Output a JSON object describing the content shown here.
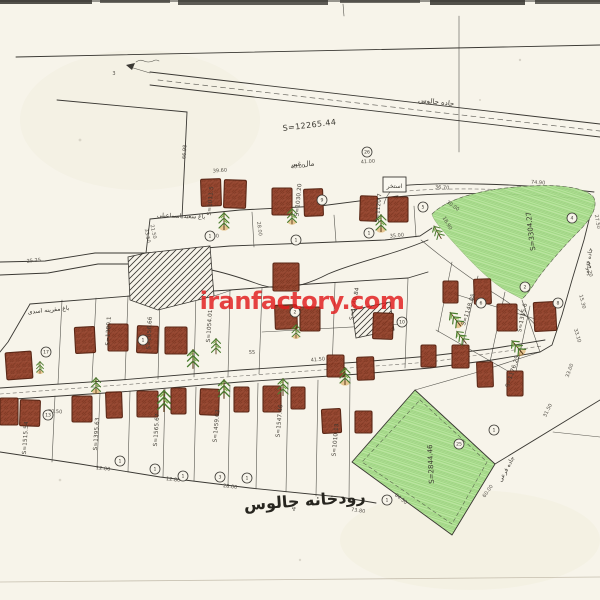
{
  "watermark": {
    "text": "iranfactory.com",
    "color": "#e21b1b"
  },
  "labels": {
    "river": "رودخانه چالوس",
    "road_top": "جاده چالوس",
    "pool": "استخر",
    "side_road_1": "جاده فرعی",
    "side_road_2": "جاده فرعی",
    "others_property": "مال غیر",
    "orchard_note_1": "باغ سعید اسماعیلی",
    "orchard_note_2": "باغ مقرینه اسدی",
    "total_area": "S=12265.44",
    "green_area_top": "S=3304.27",
    "green_area_bottom": "S=2844.46"
  },
  "plot_area_labels": [
    {
      "t": "S=1011.5",
      "x": 212,
      "y": 201,
      "r": -85
    },
    {
      "t": "S=1030.20",
      "x": 300,
      "y": 200,
      "r": -85
    },
    {
      "t": "S=1120.7",
      "x": 380,
      "y": 208,
      "r": -85
    },
    {
      "t": "S=1380.1",
      "x": 110,
      "y": 331,
      "r": -87
    },
    {
      "t": "S=1056.66",
      "x": 151,
      "y": 333,
      "r": -87
    },
    {
      "t": "S=1054.01",
      "x": 211,
      "y": 326,
      "r": -86
    },
    {
      "t": "S=1249.84",
      "x": 356,
      "y": 304,
      "r": -80
    },
    {
      "t": "S=1148.05",
      "x": 470,
      "y": 310,
      "r": -72
    },
    {
      "t": "S=1176.25",
      "x": 514,
      "y": 372,
      "r": -72
    },
    {
      "t": "S=1315.6",
      "x": 524,
      "y": 318,
      "r": -78
    },
    {
      "t": "S=1515.54",
      "x": 27,
      "y": 438,
      "r": -86
    },
    {
      "t": "S=1395.63",
      "x": 98,
      "y": 434,
      "r": -86
    },
    {
      "t": "S=1565.67",
      "x": 158,
      "y": 430,
      "r": -86
    },
    {
      "t": "S=1459.03",
      "x": 218,
      "y": 426,
      "r": -85
    },
    {
      "t": "S=1547.46",
      "x": 281,
      "y": 421,
      "r": -85
    },
    {
      "t": "S=1010.13",
      "x": 337,
      "y": 440,
      "r": -85
    }
  ],
  "dimensions": [
    {
      "t": "66.98",
      "x": 186,
      "y": 152,
      "r": -86
    },
    {
      "t": "21.50",
      "x": 152,
      "y": 232,
      "r": 78
    },
    {
      "t": "39.60",
      "x": 220,
      "y": 172,
      "r": -4
    },
    {
      "t": "40.00",
      "x": 298,
      "y": 168,
      "r": -4
    },
    {
      "t": "41.00",
      "x": 368,
      "y": 163,
      "r": -4
    },
    {
      "t": "36.70",
      "x": 442,
      "y": 189,
      "r": 4
    },
    {
      "t": "74.90",
      "x": 538,
      "y": 184,
      "r": 4
    },
    {
      "t": "27.50",
      "x": 596,
      "y": 222,
      "r": 80
    },
    {
      "t": "30.00",
      "x": 452,
      "y": 207,
      "r": 35
    },
    {
      "t": "18.90",
      "x": 446,
      "y": 224,
      "r": 60
    },
    {
      "t": "30.50",
      "x": 212,
      "y": 238,
      "r": -6
    },
    {
      "t": "28.00",
      "x": 258,
      "y": 229,
      "r": 82
    },
    {
      "t": "25.25",
      "x": 34,
      "y": 262,
      "r": -6
    },
    {
      "t": "33.50",
      "x": 146,
      "y": 236,
      "r": 80
    },
    {
      "t": "41.50",
      "x": 318,
      "y": 361,
      "r": -5
    },
    {
      "t": "55",
      "x": 252,
      "y": 354,
      "r": 0
    },
    {
      "t": "12.00",
      "x": 103,
      "y": 470,
      "r": 6
    },
    {
      "t": "12.80",
      "x": 173,
      "y": 481,
      "r": 7
    },
    {
      "t": "28.00",
      "x": 230,
      "y": 488,
      "r": 7
    },
    {
      "t": "73.80",
      "x": 358,
      "y": 512,
      "r": 8
    },
    {
      "t": "84.50",
      "x": 400,
      "y": 500,
      "r": 38
    },
    {
      "t": "60.00",
      "x": 489,
      "y": 492,
      "r": -55
    },
    {
      "t": "31.50",
      "x": 549,
      "y": 411,
      "r": -64
    },
    {
      "t": "33.00",
      "x": 571,
      "y": 371,
      "r": -70
    },
    {
      "t": "15.30",
      "x": 581,
      "y": 302,
      "r": 76
    },
    {
      "t": "12.20",
      "x": 588,
      "y": 270,
      "r": 77
    },
    {
      "t": "33.10",
      "x": 576,
      "y": 336,
      "r": 73
    },
    {
      "t": "35.00",
      "x": 397,
      "y": 237,
      "r": -5
    },
    {
      "t": "30.50",
      "x": 55,
      "y": 413,
      "r": 3
    },
    {
      "t": "3",
      "x": 114,
      "y": 75,
      "r": 0
    }
  ],
  "plot_numbers": [
    {
      "n": "26",
      "x": 367,
      "y": 152
    },
    {
      "n": "9",
      "x": 322,
      "y": 200
    },
    {
      "n": "5",
      "x": 423,
      "y": 207
    },
    {
      "n": "1",
      "x": 210,
      "y": 236
    },
    {
      "n": "1",
      "x": 296,
      "y": 240
    },
    {
      "n": "1",
      "x": 369,
      "y": 233
    },
    {
      "n": "4",
      "x": 572,
      "y": 218
    },
    {
      "n": "6",
      "x": 481,
      "y": 303
    },
    {
      "n": "2",
      "x": 525,
      "y": 287
    },
    {
      "n": "8",
      "x": 558,
      "y": 303
    },
    {
      "n": "1",
      "x": 494,
      "y": 430
    },
    {
      "n": "1",
      "x": 387,
      "y": 500
    },
    {
      "n": "25",
      "x": 459,
      "y": 444
    },
    {
      "n": "2",
      "x": 295,
      "y": 312
    },
    {
      "n": "10",
      "x": 402,
      "y": 322
    },
    {
      "n": "17",
      "x": 46,
      "y": 352
    },
    {
      "n": "1",
      "x": 143,
      "y": 340
    },
    {
      "n": "13",
      "x": 48,
      "y": 415
    },
    {
      "n": "1",
      "x": 120,
      "y": 461
    },
    {
      "n": "1",
      "x": 155,
      "y": 469
    },
    {
      "n": "1",
      "x": 183,
      "y": 476
    },
    {
      "n": "3",
      "x": 220,
      "y": 477
    },
    {
      "n": "1",
      "x": 247,
      "y": 478
    }
  ],
  "buildings": [
    [
      201,
      179,
      20,
      27,
      -2
    ],
    [
      224,
      180,
      22,
      28,
      2
    ],
    [
      272,
      188,
      20,
      27,
      0
    ],
    [
      304,
      189,
      19,
      27,
      -2
    ],
    [
      360,
      196,
      17,
      25,
      2
    ],
    [
      388,
      197,
      20,
      25,
      0
    ],
    [
      75,
      327,
      20,
      26,
      -3
    ],
    [
      108,
      324,
      20,
      27,
      0
    ],
    [
      137,
      326,
      21,
      27,
      2
    ],
    [
      165,
      327,
      22,
      27,
      0
    ],
    [
      6,
      352,
      26,
      27,
      -4
    ],
    [
      273,
      263,
      26,
      28,
      0
    ],
    [
      275,
      305,
      22,
      24,
      -2
    ],
    [
      300,
      307,
      20,
      24,
      0
    ],
    [
      373,
      313,
      20,
      26,
      2
    ],
    [
      327,
      355,
      17,
      22,
      0
    ],
    [
      357,
      357,
      17,
      23,
      -2
    ],
    [
      421,
      345,
      15,
      22,
      0
    ],
    [
      443,
      281,
      15,
      22,
      0
    ],
    [
      474,
      279,
      17,
      25,
      -2
    ],
    [
      497,
      304,
      20,
      27,
      0
    ],
    [
      534,
      302,
      22,
      29,
      -3
    ],
    [
      452,
      345,
      17,
      23,
      0
    ],
    [
      477,
      362,
      16,
      25,
      -2
    ],
    [
      507,
      371,
      16,
      25,
      0
    ],
    [
      0,
      398,
      18,
      27,
      0
    ],
    [
      20,
      400,
      20,
      26,
      2
    ],
    [
      72,
      396,
      20,
      26,
      0
    ],
    [
      106,
      392,
      16,
      26,
      -2
    ],
    [
      137,
      391,
      21,
      26,
      0
    ],
    [
      171,
      388,
      15,
      26,
      0
    ],
    [
      200,
      389,
      19,
      26,
      2
    ],
    [
      234,
      387,
      15,
      25,
      0
    ],
    [
      263,
      386,
      18,
      26,
      0
    ],
    [
      291,
      387,
      14,
      22,
      0
    ],
    [
      322,
      409,
      19,
      24,
      -3
    ],
    [
      355,
      411,
      17,
      22,
      0
    ]
  ],
  "trees": [
    [
      224,
      222,
      1,
      0,
      1
    ],
    [
      292,
      217,
      0.9,
      0,
      1
    ],
    [
      381,
      224,
      1,
      0,
      1
    ],
    [
      438,
      233,
      0.85,
      -30,
      0
    ],
    [
      193,
      360,
      1.1,
      0,
      0
    ],
    [
      216,
      347,
      0.9,
      0,
      0
    ],
    [
      96,
      386,
      0.9,
      0,
      1
    ],
    [
      164,
      402,
      1.25,
      0,
      0
    ],
    [
      224,
      390,
      1.1,
      0,
      0
    ],
    [
      283,
      388,
      1,
      0,
      0
    ],
    [
      345,
      377,
      1,
      0,
      1
    ],
    [
      456,
      320,
      1,
      -38,
      1
    ],
    [
      462,
      338,
      0.9,
      -38,
      0
    ],
    [
      518,
      348,
      1,
      -40,
      1
    ],
    [
      40,
      368,
      0.7,
      0,
      1
    ],
    [
      296,
      332,
      0.8,
      0,
      1
    ]
  ],
  "colors": {
    "paper": "#f7f4ea",
    "ink": "#3a3833",
    "building_fill": "#93412a",
    "building_stroke": "#55200f",
    "green_fill": "#b7e49c",
    "tree_green": "#4a7c2f",
    "tree_orange": "#d79a3a",
    "watermark_red": "#e21b1b"
  }
}
